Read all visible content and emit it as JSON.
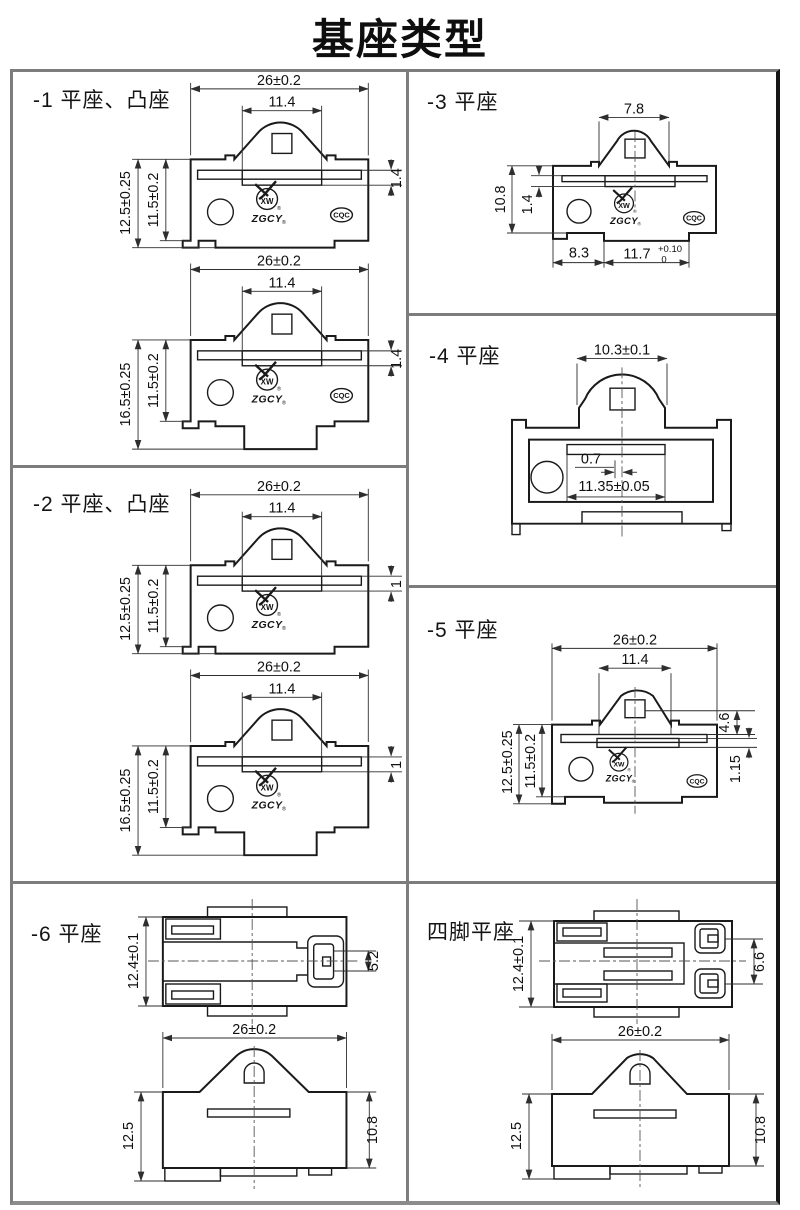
{
  "title": "基座类型",
  "logo": {
    "xw": "XW",
    "zgcy": "ZGCY",
    "reg": "®",
    "cqc": "CQC"
  },
  "p1": {
    "label": "-1 平座、凸座",
    "d1": {
      "w": "26±0.2",
      "inner": "11.4",
      "h1": "12.5±0.25",
      "h2": "11.5±0.2",
      "t": "1.4"
    },
    "d2": {
      "w": "26±0.2",
      "inner": "11.4",
      "h1": "16.5±0.25",
      "h2": "11.5±0.2",
      "t": "1.4"
    }
  },
  "p2": {
    "label": "-2 平座、凸座",
    "d1": {
      "w": "26±0.2",
      "inner": "11.4",
      "h1": "12.5±0.25",
      "h2": "11.5±0.2",
      "t": "1"
    },
    "d2": {
      "w": "26±0.2",
      "inner": "11.4",
      "h1": "16.5±0.25",
      "h2": "11.5±0.2",
      "t": "1"
    }
  },
  "p3": {
    "label": "-3 平座",
    "d": {
      "top": "7.8",
      "h": "10.8",
      "t": "1.4",
      "b1": "8.3",
      "b2": "11.7",
      "b2sup": "+0.10",
      "b2sub": "0"
    }
  },
  "p4": {
    "label": "-4 平座",
    "d": {
      "top": "10.3±0.1",
      "off": "0.7",
      "slot": "11.35±0.05"
    }
  },
  "p5": {
    "label": "-5 平座",
    "d": {
      "w": "26±0.2",
      "inner": "11.4",
      "h1": "12.5±0.25",
      "h2": "11.5±0.2",
      "r1": "4.6",
      "r2": "1.15"
    }
  },
  "p6": {
    "label": "-6 平座",
    "tv": {
      "h": "12.4±0.1",
      "s": "5.2"
    },
    "fv": {
      "w": "26±0.2",
      "h1": "12.5",
      "h2": "10.8"
    }
  },
  "p7": {
    "label": "四脚平座",
    "tv": {
      "h": "12.4±0.1",
      "s": "6.6"
    },
    "fv": {
      "w": "26±0.2",
      "h1": "12.5",
      "h2": "10.8"
    }
  }
}
